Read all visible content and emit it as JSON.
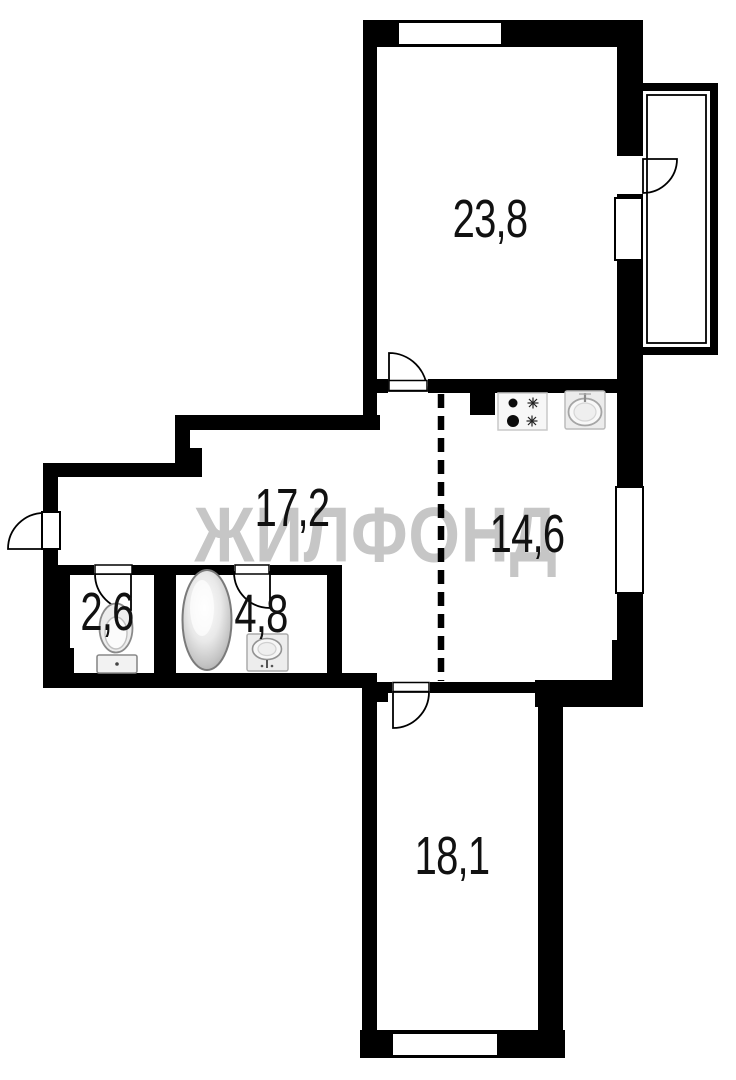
{
  "watermark": {
    "text": "ЖИЛФОНД",
    "color": "#c6c6c6"
  },
  "plan": {
    "wall_color": "#000000",
    "background": "#ffffff",
    "rooms": [
      {
        "area": "23,8"
      },
      {
        "area": "17,2"
      },
      {
        "area": "14,6"
      },
      {
        "area": "2,6"
      },
      {
        "area": "4,8"
      },
      {
        "area": "18,1"
      }
    ],
    "icons": [
      "stove-icon",
      "kitchen-sink-icon",
      "toilet-icon",
      "bathtub-icon",
      "bathroom-sink-icon",
      "door-arc-icon",
      "window-icon",
      "dashed-divider-icon"
    ]
  }
}
